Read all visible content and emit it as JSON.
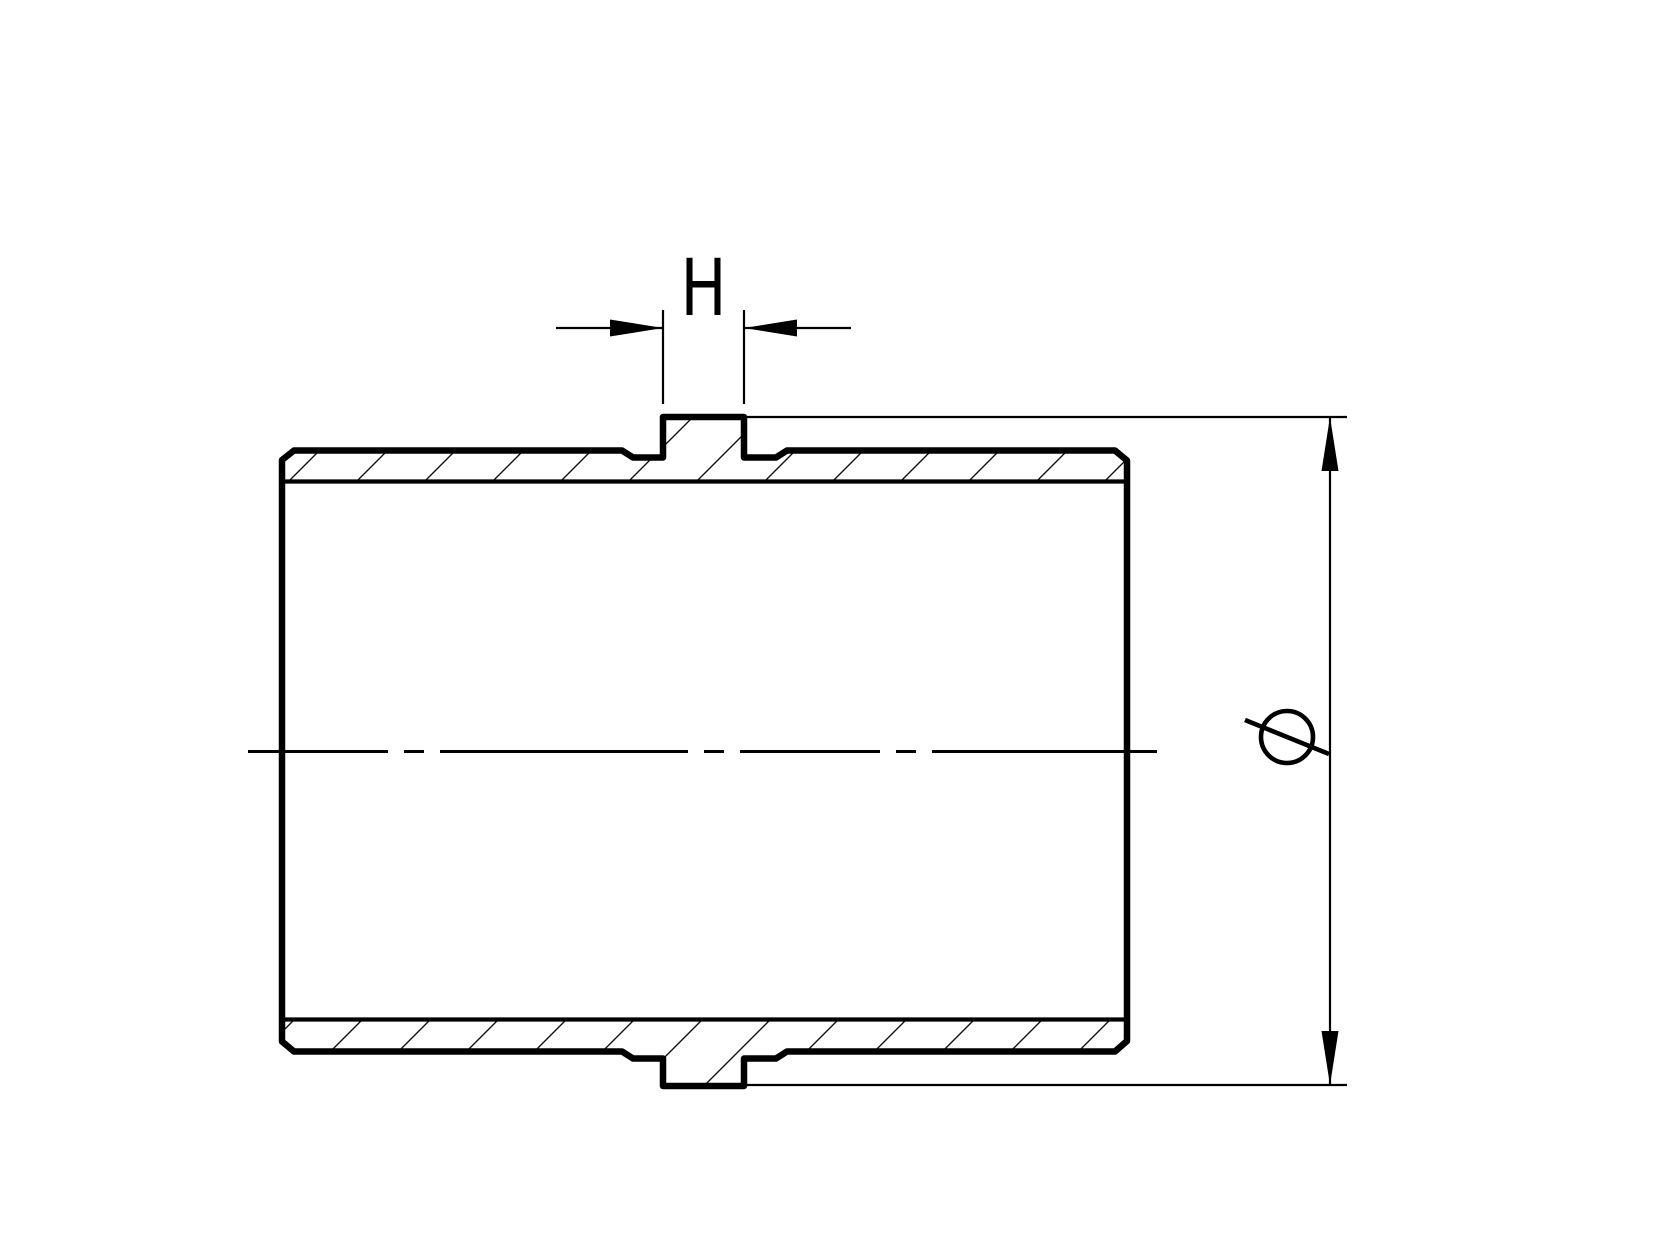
{
  "page": {
    "background_color": "#ffffff",
    "line_color": "#000000"
  },
  "drawing": {
    "type": "engineering-section-view",
    "description": "Cross-section of a cylindrical sleeve / pipe coupling with a small central rib boss, section hatching, centerline, rib-width dimension and outer-diameter dimension",
    "labels": {
      "boss_width": "H",
      "diameter_symbol": "⌀"
    }
  }
}
